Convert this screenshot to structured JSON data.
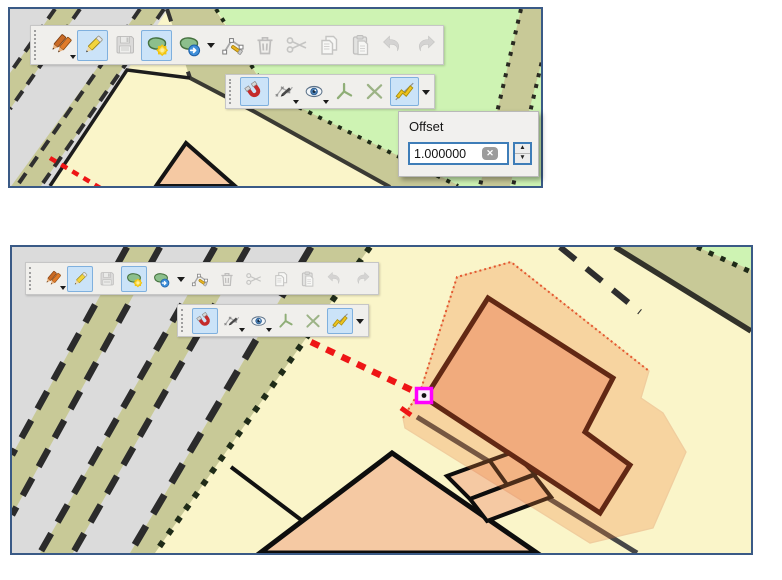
{
  "offset_popup": {
    "label": "Offset",
    "value": "1.000000"
  },
  "toolbars": {
    "digitizing": {
      "buttons": [
        {
          "icon": "current-edits",
          "state": "normal",
          "corner": true
        },
        {
          "icon": "toggle-editing",
          "state": "active"
        },
        {
          "icon": "save-edits",
          "state": "disabled"
        },
        {
          "icon": "add-feature",
          "state": "active"
        },
        {
          "icon": "move-feature",
          "state": "normal",
          "dropdown": true
        },
        {
          "icon": "node-tool",
          "state": "normal"
        },
        {
          "icon": "delete-selected",
          "state": "disabled"
        },
        {
          "icon": "cut-features",
          "state": "disabled"
        },
        {
          "icon": "copy-features",
          "state": "disabled"
        },
        {
          "icon": "paste-features",
          "state": "disabled"
        },
        {
          "icon": "undo",
          "state": "disabled"
        },
        {
          "icon": "redo",
          "state": "disabled"
        }
      ]
    },
    "snapping": {
      "buttons": [
        {
          "icon": "snapping-magnet",
          "state": "active"
        },
        {
          "icon": "vertex-tool",
          "state": "normal",
          "corner": true
        },
        {
          "icon": "topology-eye",
          "state": "normal",
          "corner": true
        },
        {
          "icon": "tracing",
          "state": "normal"
        },
        {
          "icon": "intersection",
          "state": "normal"
        },
        {
          "icon": "offset-curve",
          "state": "active",
          "dropdown": true
        }
      ]
    }
  },
  "colors": {
    "panel_border": "#3A5A86",
    "toolbar_bg": "#F0EFEC",
    "toolbar_border": "#C6C6C6",
    "active_button_bg": "#CBE3F8",
    "active_button_border": "#7FB0DE",
    "spinbox_border": "#3E7DB8",
    "map_yellow": "#FAF5C9",
    "map_gray": "#DBDBDB",
    "map_green": "#CEF3B3",
    "map_road_olive": "#C8C997",
    "building_fill": "#F5C9A3",
    "building_fill_selected": "#F2BD99",
    "offset_highlight_stroke": "#D96A33",
    "rubber_band_red": "#EE1515",
    "vertex_marker_magenta": "#FF00FF"
  }
}
